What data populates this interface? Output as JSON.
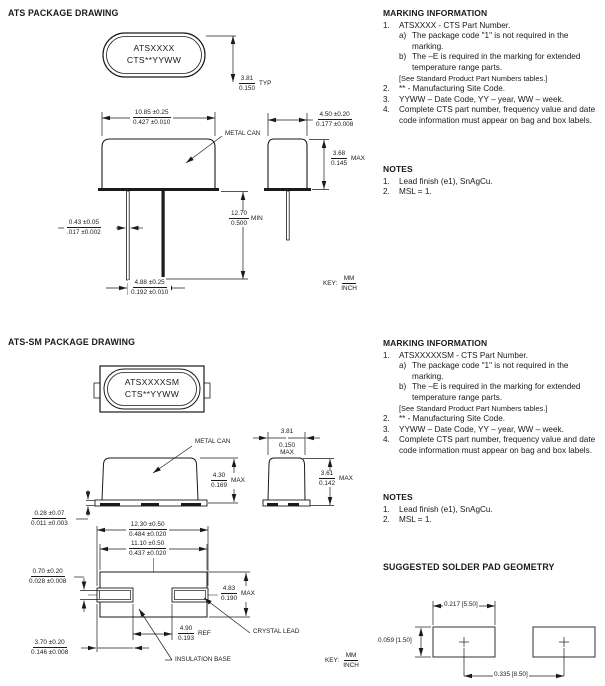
{
  "key_abbr": {
    "label": "KEY:",
    "numerator": "MM",
    "denominator": "INCH"
  },
  "ats": {
    "section_title": "ATS PACKAGE DRAWING",
    "top_view": {
      "marking_line1": "ATSXXXX",
      "marking_line2": "CTS**YYWW"
    },
    "callouts": {
      "metal_can": "METAL CAN"
    },
    "dims": {
      "marking_height": {
        "mm": "3.81",
        "inch": "0.150",
        "suffix": "TYP"
      },
      "body_width": {
        "mm": "10.85 ±0.25",
        "inch": "0.427 ±0.010"
      },
      "body_depth": {
        "mm": "4.50 ±0.20",
        "inch": "0.177 ±0.008"
      },
      "body_height": {
        "mm": "3.68",
        "inch": "0.145",
        "suffix": "MAX"
      },
      "lead_length": {
        "mm": "12.70",
        "inch": "0.500",
        "suffix": "MIN"
      },
      "lead_dia": {
        "mm": "0.43 ±0.05",
        "inch": ".017 ±0.002"
      },
      "lead_spacing": {
        "mm": "4.88 ±0.25",
        "inch": "0.192 ±0.010"
      }
    },
    "marking_info": {
      "heading": "MARKING INFORMATION",
      "item1_num": "1.",
      "item1_text": "ATSXXXX - CTS Part Number.",
      "item1a_num": "a)",
      "item1a_text": "The package code \"1\" is not required in the marking.",
      "item1b_num": "b)",
      "item1b_text": "The –E is required in the marking for extended temperature range parts.",
      "item1_bracket": "[See Standard Product Part Numbers tables.]",
      "item2_num": "2.",
      "item2_text": "** - Manufacturing Site Code.",
      "item3_num": "3.",
      "item3_text": "YYWW – Date Code, YY – year, WW – week.",
      "item4_num": "4.",
      "item4_text": "Complete CTS part number, frequency value and date code information must appear on bag and box labels."
    },
    "notes": {
      "heading": "NOTES",
      "item1_num": "1.",
      "item1_text": "Lead finish (e1), SnAgCu.",
      "item2_num": "2.",
      "item2_text": "MSL = 1."
    }
  },
  "atssm": {
    "section_title": "ATS-SM PACKAGE DRAWING",
    "top_view": {
      "marking_line1": "ATSXXXXSM",
      "marking_line2": "CTS**YYWW"
    },
    "callouts": {
      "metal_can": "METAL CAN",
      "crystal_lead": "CRYSTAL LEAD",
      "insulation_base": "INSULATION BASE"
    },
    "dims": {
      "can_height": {
        "mm": "4.30",
        "inch": "0.169",
        "suffix": "MAX"
      },
      "base_thickness": {
        "mm": "0.28 ±0.07",
        "inch": "0.011 ±0.003"
      },
      "can_width_top": {
        "mm": "3.81",
        "inch": "0.150",
        "suffix": "MAX"
      },
      "can_height_end": {
        "mm": "3.61",
        "inch": "0.142",
        "suffix": "MAX"
      },
      "overall_length": {
        "mm": "12.30 ±0.50",
        "inch": "0.484 ±0.020"
      },
      "body_length": {
        "mm": "11.10 ±0.50",
        "inch": "0.437 ±0.020"
      },
      "lead_thickness": {
        "mm": "0.70 ±0.20",
        "inch": "0.028 ±0.008"
      },
      "body_width": {
        "mm": "4.83",
        "inch": "0.190",
        "suffix": "MAX"
      },
      "lead_gap": {
        "mm": "4.90",
        "inch": "0.193",
        "suffix": "REF"
      },
      "lead_width": {
        "mm": "3.70 ±0.20",
        "inch": "0.146 ±0.008"
      }
    },
    "marking_info": {
      "heading": "MARKING INFORMATION",
      "item1_num": "1.",
      "item1_text": "ATSXXXXXSM - CTS Part Number.",
      "item1a_num": "a)",
      "item1a_text": "The package code \"1\" is not required in the marking.",
      "item1b_num": "b)",
      "item1b_text": "The –E is required in the marking for extended temperature range parts.",
      "item1_bracket": "[See Standard Product Part Numbers tables.]",
      "item2_num": "2.",
      "item2_text": "** - Manufacturing Site Code.",
      "item3_num": "3.",
      "item3_text": "YYWW – Date Code, YY – year, WW – week.",
      "item4_num": "4.",
      "item4_text": "Complete CTS part number, frequency value and date code information must appear on bag and box labels."
    },
    "notes": {
      "heading": "NOTES",
      "item1_num": "1.",
      "item1_text": "Lead finish (e1), SnAgCu.",
      "item2_num": "2.",
      "item2_text": "MSL = 1."
    }
  },
  "solder_pad": {
    "heading": "SUGGESTED SOLDER PAD GEOMETRY",
    "pad_width": "0.217 [5.50]",
    "pad_height": "0.059 [1.50]",
    "pad_pitch": "0.335 [8.50]"
  }
}
